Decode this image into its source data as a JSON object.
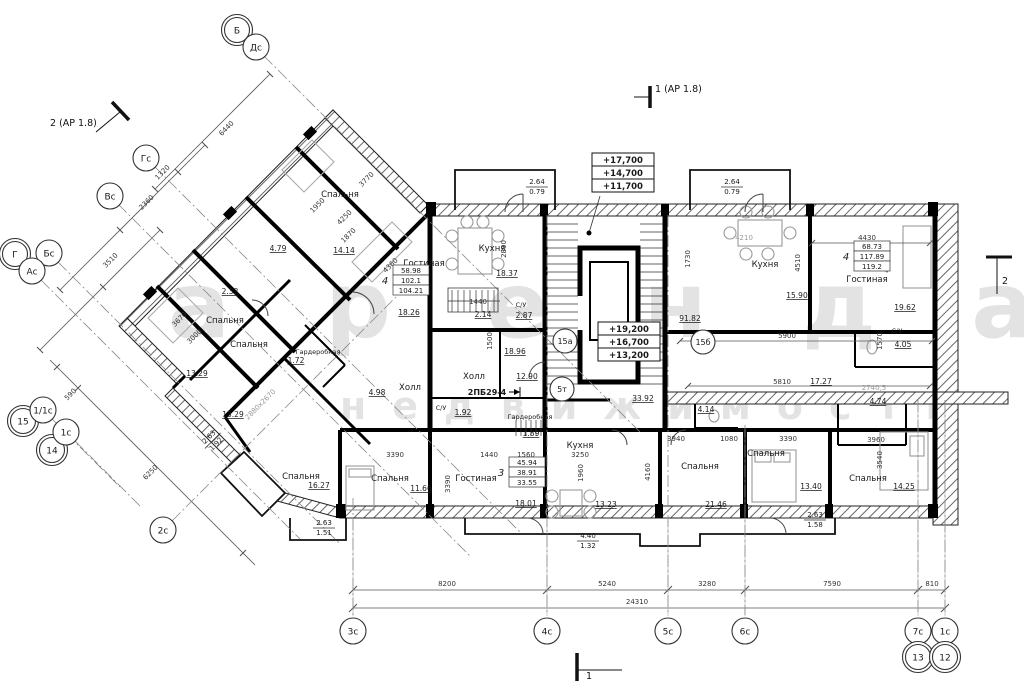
{
  "watermark": {
    "line1": "аренда",
    "line2": "недвижимость"
  },
  "sections": {
    "top_left": "2 (АР 1.8)",
    "top_center": "1 (АР 1.8)",
    "bottom": "1",
    "right": "2"
  },
  "elev_boxes": [
    {
      "name": "elevation-upper",
      "x": 592,
      "y": 153,
      "rows": [
        "+17,700",
        "+14,700",
        "+11,700"
      ]
    },
    {
      "name": "elevation-stair",
      "x": 598,
      "y": 322,
      "rows": [
        "+19,200",
        "+16,700",
        "+13,200"
      ]
    }
  ],
  "area_tables": [
    {
      "name": "area-table-left",
      "x": 393,
      "y": 265,
      "count": "4",
      "rows": [
        "58.98",
        "102.1",
        "104.21"
      ]
    },
    {
      "name": "area-table-right",
      "x": 854,
      "y": 241,
      "count": "4",
      "rows": [
        "68.73",
        "117.89",
        "119.2"
      ]
    },
    {
      "name": "area-table-bottom",
      "x": 509,
      "y": 457,
      "count": "3",
      "rows": [
        "45.94",
        "38.91",
        "33.55"
      ]
    }
  ],
  "units": [
    {
      "label": "15а",
      "x": 565,
      "y": 341
    },
    {
      "label": "15б",
      "x": 703,
      "y": 342
    },
    {
      "label": "5т",
      "x": 562,
      "y": 389
    }
  ],
  "bubbles": [
    {
      "t": "Б",
      "x": 237,
      "y": 30,
      "d": 1
    },
    {
      "t": "Дс",
      "x": 256,
      "y": 47
    },
    {
      "t": "Гс",
      "x": 146,
      "y": 158
    },
    {
      "t": "Вс",
      "x": 110,
      "y": 196
    },
    {
      "t": "Г",
      "x": 15,
      "y": 254,
      "d": 1
    },
    {
      "t": "Бс",
      "x": 49,
      "y": 253
    },
    {
      "t": "Ас",
      "x": 32,
      "y": 271
    },
    {
      "t": "15",
      "x": 23,
      "y": 421,
      "d": 1
    },
    {
      "t": "1/1с",
      "x": 43,
      "y": 410
    },
    {
      "t": "14",
      "x": 52,
      "y": 450,
      "d": 1
    },
    {
      "t": "1с",
      "x": 66,
      "y": 432
    },
    {
      "t": "2с",
      "x": 163,
      "y": 530
    },
    {
      "t": "3с",
      "x": 353,
      "y": 631
    },
    {
      "t": "4с",
      "x": 547,
      "y": 631
    },
    {
      "t": "5с",
      "x": 668,
      "y": 631
    },
    {
      "t": "6с",
      "x": 745,
      "y": 631
    },
    {
      "t": "7с",
      "x": 918,
      "y": 631
    },
    {
      "t": "13",
      "x": 918,
      "y": 657,
      "d": 1
    },
    {
      "t": "1с",
      "x": 945,
      "y": 631
    },
    {
      "t": "12",
      "x": 945,
      "y": 657,
      "d": 1
    }
  ],
  "balconies": [
    {
      "a": "2.64",
      "b": "0.79",
      "x": 537,
      "y": 186
    },
    {
      "a": "2.64",
      "b": "0.79",
      "x": 732,
      "y": 186
    },
    {
      "a": "2.63",
      "b": "1.92",
      "x": 212,
      "y": 440,
      "r": -45
    },
    {
      "a": "2.63",
      "b": "1.51",
      "x": 324,
      "y": 527
    },
    {
      "a": "4.40",
      "b": "1.32",
      "x": 588,
      "y": 540
    },
    {
      "a": "2.63",
      "b": "1.58",
      "x": 815,
      "y": 519
    }
  ],
  "labels": [
    {
      "t": "Спальня",
      "x": 340,
      "y": 197,
      "c": "room"
    },
    {
      "t": "Спальня",
      "x": 225,
      "y": 323,
      "c": "room"
    },
    {
      "t": "Спальня",
      "x": 249,
      "y": 347,
      "c": "room"
    },
    {
      "t": "Спальня",
      "x": 301,
      "y": 479,
      "c": "room"
    },
    {
      "t": "Спальня",
      "x": 390,
      "y": 481,
      "c": "room"
    },
    {
      "t": "Спальня",
      "x": 700,
      "y": 469,
      "c": "room"
    },
    {
      "t": "Спальня",
      "x": 766,
      "y": 456,
      "c": "room"
    },
    {
      "t": "Спальня",
      "x": 868,
      "y": 481,
      "c": "room"
    },
    {
      "t": "Гостиная",
      "x": 424,
      "y": 266,
      "c": "room"
    },
    {
      "t": "Гостиная",
      "x": 867,
      "y": 282,
      "c": "room"
    },
    {
      "t": "Гостиная",
      "x": 476,
      "y": 481,
      "c": "room"
    },
    {
      "t": "Кухня",
      "x": 492,
      "y": 251,
      "c": "room"
    },
    {
      "t": "Кухня",
      "x": 765,
      "y": 267,
      "c": "room"
    },
    {
      "t": "Кухня",
      "x": 580,
      "y": 448,
      "c": "room"
    },
    {
      "t": " Холл",
      "x": 474,
      "y": 379,
      "c": "room"
    },
    {
      "t": "Холл",
      "x": 410,
      "y": 390,
      "c": "room"
    },
    {
      "t": "Гардеробная",
      "x": 318,
      "y": 354,
      "c": "tiny"
    },
    {
      "t": "Гардеробная",
      "x": 530,
      "y": 419,
      "c": "tiny"
    },
    {
      "t": "С/У",
      "x": 897,
      "y": 333,
      "c": "tiny"
    },
    {
      "t": "С/У",
      "x": 441,
      "y": 410,
      "c": "tiny"
    },
    {
      "t": "С/У",
      "x": 521,
      "y": 307,
      "c": "tiny"
    },
    {
      "t": "14.14",
      "x": 344,
      "y": 253,
      "c": "area"
    },
    {
      "t": "2.32",
      "x": 230,
      "y": 294,
      "c": "area"
    },
    {
      "t": "4.79",
      "x": 278,
      "y": 251,
      "c": "area"
    },
    {
      "t": "13.29",
      "x": 197,
      "y": 376,
      "c": "area"
    },
    {
      "t": "13.29",
      "x": 233,
      "y": 417,
      "c": "area"
    },
    {
      "t": "16.27",
      "x": 319,
      "y": 488,
      "c": "area"
    },
    {
      "t": "18.26",
      "x": 409,
      "y": 315,
      "c": "area"
    },
    {
      "t": "18.37",
      "x": 507,
      "y": 276,
      "c": "area"
    },
    {
      "t": "2.14",
      "x": 483,
      "y": 317,
      "c": "area"
    },
    {
      "t": "2.87",
      "x": 524,
      "y": 318,
      "c": "area"
    },
    {
      "t": "18.96",
      "x": 515,
      "y": 354,
      "c": "area"
    },
    {
      "t": "12.90",
      "x": 527,
      "y": 379,
      "c": "area"
    },
    {
      "t": "4.98",
      "x": 377,
      "y": 395,
      "c": "area"
    },
    {
      "t": "1.92",
      "x": 463,
      "y": 415,
      "c": "area"
    },
    {
      "t": "1.89",
      "x": 531,
      "y": 436,
      "c": "area"
    },
    {
      "t": "1.72",
      "x": 296,
      "y": 363,
      "c": "area"
    },
    {
      "t": "33.92",
      "x": 643,
      "y": 401,
      "c": "area"
    },
    {
      "t": "91.82",
      "x": 690,
      "y": 321,
      "c": "area"
    },
    {
      "t": "15.90",
      "x": 797,
      "y": 298,
      "c": "area"
    },
    {
      "t": "19.62",
      "x": 905,
      "y": 310,
      "c": "area"
    },
    {
      "t": "4.05",
      "x": 903,
      "y": 347,
      "c": "area"
    },
    {
      "t": "17.27",
      "x": 821,
      "y": 384,
      "c": "area"
    },
    {
      "t": "4.14",
      "x": 706,
      "y": 412,
      "c": "area"
    },
    {
      "t": "4.74",
      "x": 878,
      "y": 404,
      "c": "area"
    },
    {
      "t": "11.66",
      "x": 421,
      "y": 491,
      "c": "area"
    },
    {
      "t": "18.01",
      "x": 526,
      "y": 506,
      "c": "area"
    },
    {
      "t": "13.23",
      "x": 606,
      "y": 507,
      "c": "area"
    },
    {
      "t": "21.46",
      "x": 716,
      "y": 507,
      "c": "area"
    },
    {
      "t": "13.40",
      "x": 811,
      "y": 489,
      "c": "area"
    },
    {
      "t": "14.25",
      "x": 904,
      "y": 489,
      "c": "area"
    },
    {
      "t": "6440",
      "x": 228,
      "y": 130,
      "c": "dim",
      "r": -45
    },
    {
      "t": "1320",
      "x": 164,
      "y": 174,
      "c": "dim",
      "r": -45
    },
    {
      "t": "2360",
      "x": 148,
      "y": 204,
      "c": "dim",
      "r": -45
    },
    {
      "t": "3510",
      "x": 112,
      "y": 262,
      "c": "dim",
      "r": -45
    },
    {
      "t": "590",
      "x": 72,
      "y": 396,
      "c": "dim",
      "r": -45
    },
    {
      "t": "6250",
      "x": 152,
      "y": 474,
      "c": "dim",
      "r": -45
    },
    {
      "t": "3770",
      "x": 368,
      "y": 181,
      "c": "dim",
      "r": -45
    },
    {
      "t": "1950",
      "x": 319,
      "y": 207,
      "c": "dim",
      "r": -45
    },
    {
      "t": "4250",
      "x": 346,
      "y": 219,
      "c": "dim",
      "r": -45
    },
    {
      "t": "1870",
      "x": 350,
      "y": 237,
      "c": "dim",
      "r": -45
    },
    {
      "t": "3670",
      "x": 181,
      "y": 321,
      "c": "dim",
      "r": -45
    },
    {
      "t": "3000",
      "x": 196,
      "y": 338,
      "c": "dim",
      "r": -45
    },
    {
      "t": "4360",
      "x": 392,
      "y": 267,
      "c": "dim",
      "r": -45
    },
    {
      "t": "2880х2670",
      "x": 262,
      "y": 406,
      "c": "light",
      "r": -45
    },
    {
      "t": "1440",
      "x": 478,
      "y": 304,
      "c": "dim"
    },
    {
      "t": "4210",
      "x": 744,
      "y": 240,
      "c": "light"
    },
    {
      "t": "4430",
      "x": 867,
      "y": 240,
      "c": "dim"
    },
    {
      "t": "5900",
      "x": 787,
      "y": 338,
      "c": "dim"
    },
    {
      "t": "5810",
      "x": 782,
      "y": 384,
      "c": "dim"
    },
    {
      "t": "2740,5",
      "x": 874,
      "y": 390,
      "c": "light"
    },
    {
      "t": "3390",
      "x": 395,
      "y": 457,
      "c": "dim"
    },
    {
      "t": "1440",
      "x": 489,
      "y": 457,
      "c": "dim"
    },
    {
      "t": "1560",
      "x": 526,
      "y": 457,
      "c": "dim"
    },
    {
      "t": "3250",
      "x": 580,
      "y": 457,
      "c": "dim"
    },
    {
      "t": "3940",
      "x": 676,
      "y": 441,
      "c": "dim"
    },
    {
      "t": "1080",
      "x": 729,
      "y": 441,
      "c": "dim"
    },
    {
      "t": "3390",
      "x": 788,
      "y": 441,
      "c": "dim"
    },
    {
      "t": "3960",
      "x": 876,
      "y": 442,
      "c": "dim"
    },
    {
      "t": "8200",
      "x": 447,
      "y": 586,
      "c": "dim"
    },
    {
      "t": "5240",
      "x": 607,
      "y": 586,
      "c": "dim"
    },
    {
      "t": "3280",
      "x": 707,
      "y": 586,
      "c": "dim"
    },
    {
      "t": "7590",
      "x": 832,
      "y": 586,
      "c": "dim"
    },
    {
      "t": "810",
      "x": 932,
      "y": 586,
      "c": "dim"
    },
    {
      "t": "24310",
      "x": 637,
      "y": 604,
      "c": "dim"
    },
    {
      "t": "2890",
      "x": 506,
      "y": 249,
      "c": "dim",
      "r": -90
    },
    {
      "t": "1500",
      "x": 492,
      "y": 341,
      "c": "dim",
      "r": -90
    },
    {
      "t": "1730",
      "x": 690,
      "y": 259,
      "c": "dim",
      "r": -90
    },
    {
      "t": "4510",
      "x": 800,
      "y": 263,
      "c": "dim",
      "r": -90
    },
    {
      "t": "4510",
      "x": 889,
      "y": 264,
      "c": "dim",
      "r": -90
    },
    {
      "t": "1570",
      "x": 882,
      "y": 341,
      "c": "dim",
      "r": -90
    },
    {
      "t": "3390",
      "x": 450,
      "y": 484,
      "c": "dim",
      "r": -90
    },
    {
      "t": "1960",
      "x": 583,
      "y": 473,
      "c": "dim",
      "r": -90
    },
    {
      "t": "4160",
      "x": 650,
      "y": 472,
      "c": "dim",
      "r": -90
    },
    {
      "t": "3540",
      "x": 882,
      "y": 460,
      "c": "dim",
      "r": -90
    },
    {
      "t": "2ПБ29-4",
      "x": 487,
      "y": 395,
      "c": "mark"
    }
  ]
}
